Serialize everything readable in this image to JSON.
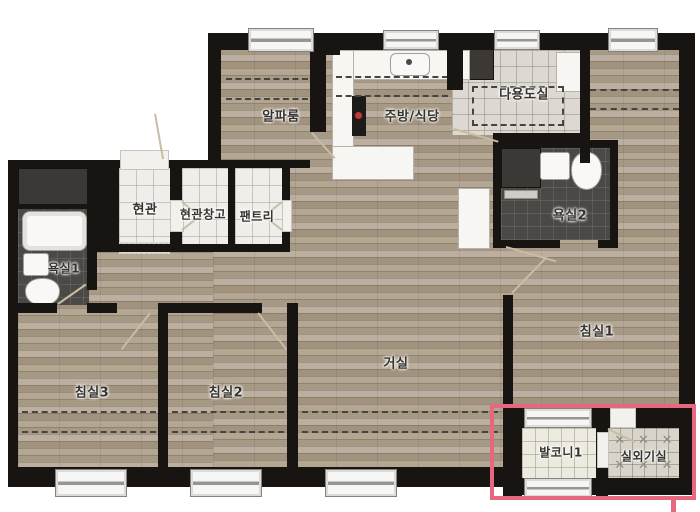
{
  "rooms": {
    "alpha_room": {
      "label": "알파룸"
    },
    "kitchen_dining": {
      "label": "주방/식당"
    },
    "utility_room": {
      "label": "다용도실"
    },
    "entrance": {
      "label": "현관"
    },
    "entrance_storage": {
      "label": "현관창고"
    },
    "pantry": {
      "label": "팬트리"
    },
    "bathroom1": {
      "label": "욕실1"
    },
    "bathroom2": {
      "label": "욕실2"
    },
    "bedroom1": {
      "label": "침실1"
    },
    "bedroom2": {
      "label": "침실2"
    },
    "bedroom3": {
      "label": "침실3"
    },
    "living_room": {
      "label": "거실"
    },
    "balcony1": {
      "label": "발코니1"
    },
    "outdoor_unit_room": {
      "label": "실외기실"
    }
  },
  "highlight": {
    "color": "#e7687e",
    "highlighted_rooms": [
      "발코니1",
      "실외기실"
    ]
  },
  "icons": {
    "louver_mark": "✕"
  },
  "colors": {
    "wall": "#171412",
    "wood_floor": "#ab9e8c",
    "tile_light": "#f0eeea",
    "tile_dark": "#4b4946",
    "highlight": "#e7687e"
  }
}
